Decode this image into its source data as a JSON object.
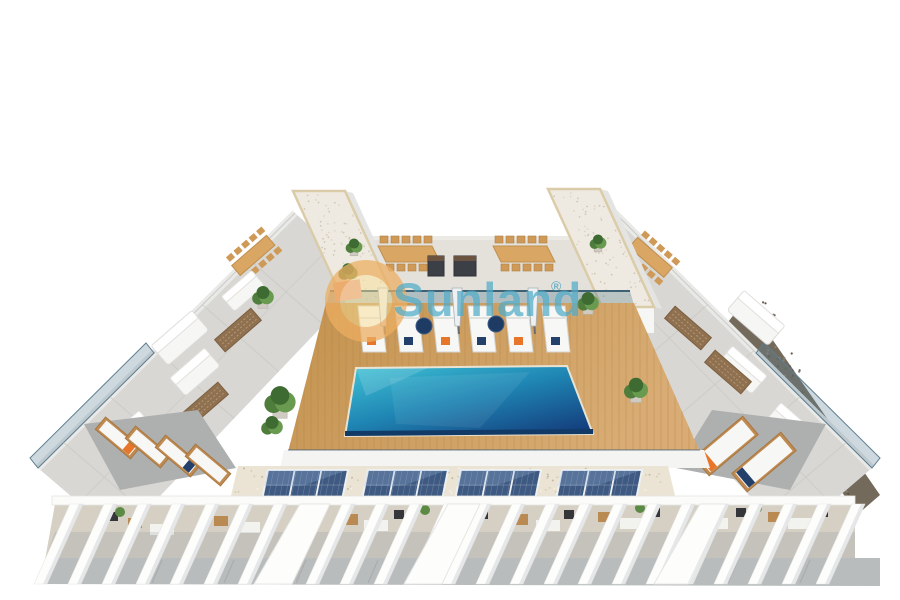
{
  "watermark": {
    "text": "Sunland",
    "mark": "®",
    "text_color": "#2b99bc",
    "logo_ring_color": "#e9944a",
    "logo_center_color": "#f8de96"
  },
  "scene": {
    "subject": "aerial-3d-render-rooftop-pool-terrace",
    "palette": {
      "pool_light": "#41c4d6",
      "pool_mid": "#1f86b4",
      "pool_dark": "#143f7e",
      "pool_edge": "#123a66",
      "deck_wood": "#cd9d64",
      "deck_wood_dark": "#b1803f",
      "tile_light": "#d8d7d3",
      "tower_roof": "#efeae1",
      "roof_trim": "#dbcca9",
      "solar_panel": "#3f5a82",
      "solar_frame": "#eef1f4",
      "gravel_beige": "#ebe4d4",
      "gravel_dark": "#746a5c",
      "glass": "#4a7288",
      "accent_orange": "#e8762a",
      "accent_navy": "#23406b",
      "pergola_white": "#fdfdfc",
      "path_gray": "#b9bcbd",
      "plant_green": "#5b8a44",
      "wood_furniture": "#c08b52",
      "planter_pink": "#e8a593"
    },
    "counts": {
      "towers": 2,
      "pool_loungers": 6,
      "pool_poufs": 2,
      "parasols": 3,
      "dining_tables_center": 2,
      "solar_arrays": 4,
      "pergola_fins": 24,
      "wing_loungers_left": 4,
      "wing_loungers_right": 2
    }
  }
}
